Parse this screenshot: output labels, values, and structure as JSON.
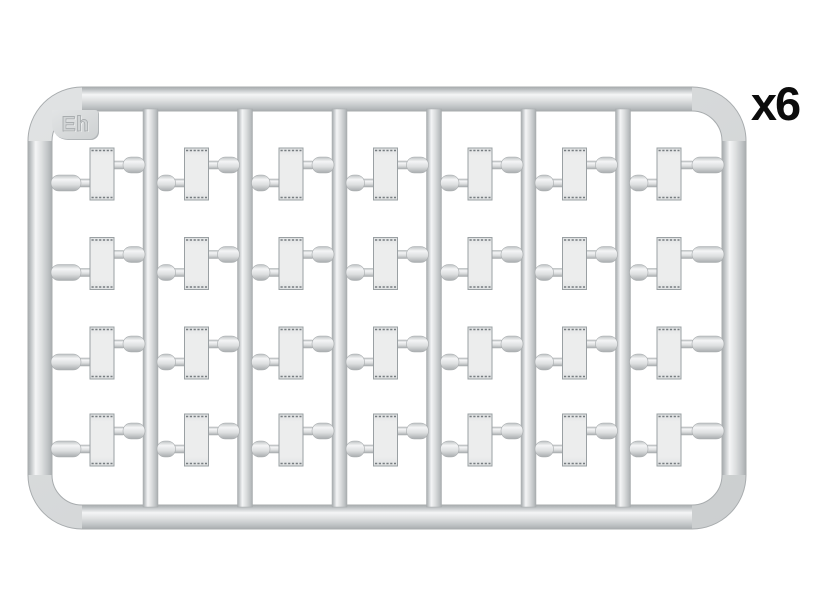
{
  "page": {
    "background": "#ffffff"
  },
  "sprue": {
    "code_label": "Eh",
    "quantity_label": "x6",
    "columns": 7,
    "rows": 4,
    "parts_total": 28,
    "runner_count": 6,
    "part_shape": "rectangular-plate",
    "colors": {
      "edge": "#a8acae",
      "shadow": "#bcc0c2",
      "mid": "#dcdedf",
      "highlight": "#f4f5f6",
      "frame_base_light": "#e1e3e4",
      "frame_base_dark": "#cbcecf",
      "part_fill": "#eceded",
      "part_fill_dark": "#e0e2e3",
      "part_edge": "#9aa0a3",
      "part_detail": "#767c80",
      "tab_light": "#e2e4e5",
      "tab_dark": "#ced1d2",
      "emboss_text": "#d2d5d6",
      "emboss_outline": "#a9adaf",
      "quantity_color": "#0c0c0c"
    }
  }
}
